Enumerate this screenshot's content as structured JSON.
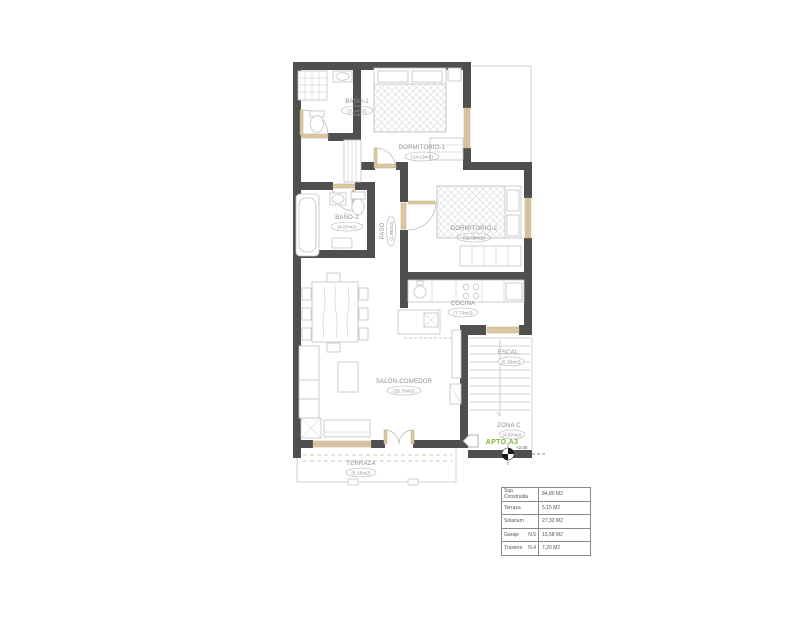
{
  "plan": {
    "colors": {
      "wall": "#4f4f4f",
      "accent_wood": "#dbc9a4",
      "furniture_line": "#c2c2c2",
      "label_text": "#8f8f8f",
      "apto_green": "#7cb52d"
    },
    "rooms": {
      "bano1": {
        "name": "BAÑO-1",
        "area": "(3.94m2)"
      },
      "dormitorio1": {
        "name": "DORMITORIO-1",
        "area": "(14.13m2)"
      },
      "bano2": {
        "name": "BAÑO-2",
        "area": "(4.07m2)"
      },
      "paso": {
        "name": "PASO",
        "area": "(1.85m2)"
      },
      "dormitorio2": {
        "name": "DORMITORIO-2",
        "area": "(11.88m2)"
      },
      "cocina": {
        "name": "COCINA",
        "area": "(7.72m2)"
      },
      "salon": {
        "name": "SALÓN-COMEDOR",
        "area": "(25.76m2)"
      },
      "terraza": {
        "name": "TERRAZA",
        "area": "(5.15m2)"
      },
      "escalera": {
        "name": "ESCAL.",
        "area": "(5.30m2)"
      },
      "zona_comun": {
        "name": "ZONA  C",
        "area": "(4.87m2)"
      }
    },
    "apartment_label": "APTO A3",
    "level_marker": "+2.00"
  },
  "summary_table": {
    "rows": [
      {
        "label": "Sup. Construida",
        "ref": "",
        "value": "84,80 M2"
      },
      {
        "label": "Terraza",
        "ref": "",
        "value": "5,15 M2"
      },
      {
        "label": "Solarium",
        "ref": "",
        "value": "27,32 M2"
      },
      {
        "label": "Garaje",
        "ref": "N.5",
        "value": "13,58 M2"
      },
      {
        "label": "Trastero",
        "ref": "N.4",
        "value": "7,20 M2"
      }
    ]
  }
}
